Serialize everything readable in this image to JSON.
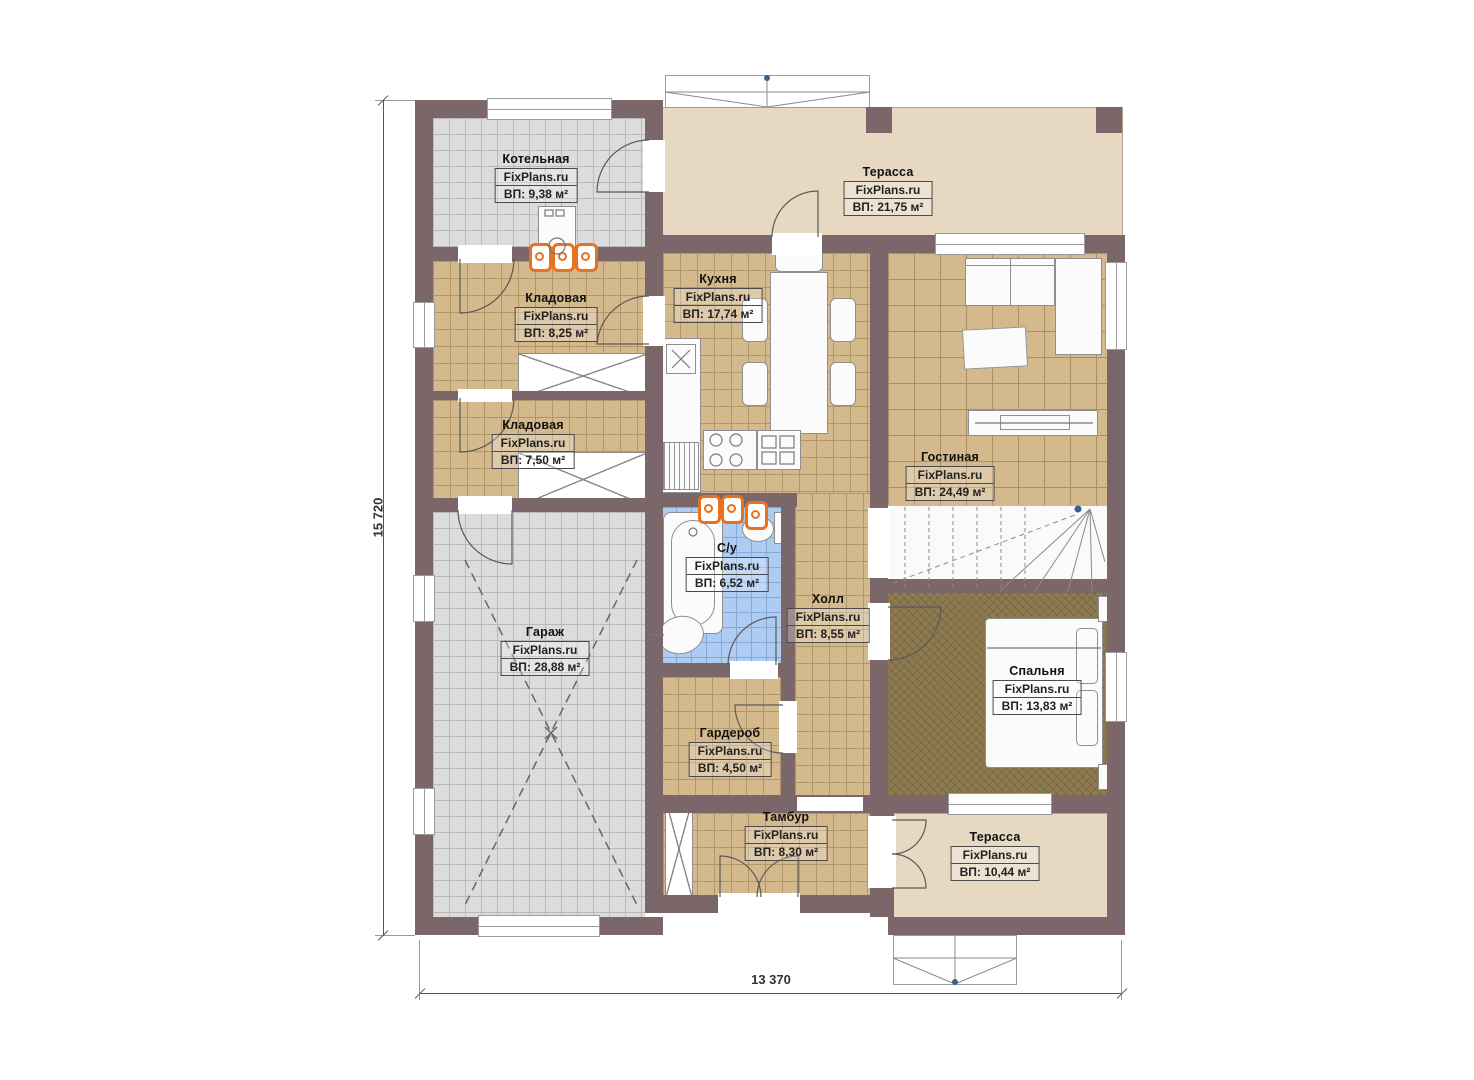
{
  "brand_site": "FixPlans.ru",
  "dimensions": {
    "left": "15 720",
    "bottom": "13 370"
  },
  "rooms": [
    {
      "id": "boiler",
      "name": "Котельная",
      "brand": "FixPlans.ru",
      "area": "ВП: 9,38 м²"
    },
    {
      "id": "terrace-top",
      "name": "Терасса",
      "brand": "FixPlans.ru",
      "area": "ВП: 21,75 м²"
    },
    {
      "id": "storage-1",
      "name": "Кладовая",
      "brand": "FixPlans.ru",
      "area": "ВП: 8,25 м²"
    },
    {
      "id": "kitchen",
      "name": "Кухня",
      "brand": "FixPlans.ru",
      "area": "ВП: 17,74 м²"
    },
    {
      "id": "storage-2",
      "name": "Кладовая",
      "brand": "FixPlans.ru",
      "area": "ВП: 7,50 м²"
    },
    {
      "id": "living-room",
      "name": "Гостиная",
      "brand": "FixPlans.ru",
      "area": "ВП: 24,49 м²"
    },
    {
      "id": "bathroom",
      "name": "С/у",
      "brand": "FixPlans.ru",
      "area": "ВП: 6,52 м²"
    },
    {
      "id": "hall",
      "name": "Холл",
      "brand": "FixPlans.ru",
      "area": "ВП: 8,55 м²"
    },
    {
      "id": "garage",
      "name": "Гараж",
      "brand": "FixPlans.ru",
      "area": "ВП: 28,88 м²"
    },
    {
      "id": "bedroom",
      "name": "Спальня",
      "brand": "FixPlans.ru",
      "area": "ВП: 13,83 м²"
    },
    {
      "id": "wardrobe",
      "name": "Гардероб",
      "brand": "FixPlans.ru",
      "area": "ВП: 4,50 м²"
    },
    {
      "id": "vestibule",
      "name": "Тамбур",
      "brand": "FixPlans.ru",
      "area": "ВП: 8,30 м²"
    },
    {
      "id": "terrace-bot",
      "name": "Терасса",
      "brand": "FixPlans.ru",
      "area": "ВП: 10,44 м²"
    }
  ],
  "colors": {
    "wall": "#7b6669",
    "tile_gray": "#dcdcdc",
    "tile_tan": "#d3b98c",
    "tile_blue": "#aecbf2",
    "terrace": "#e7d8c2",
    "carpet": "#8d7a4f",
    "radiator_orange": "#e8721f",
    "dimension_line": "#555555",
    "marker_blue": "#3b5f8f"
  }
}
